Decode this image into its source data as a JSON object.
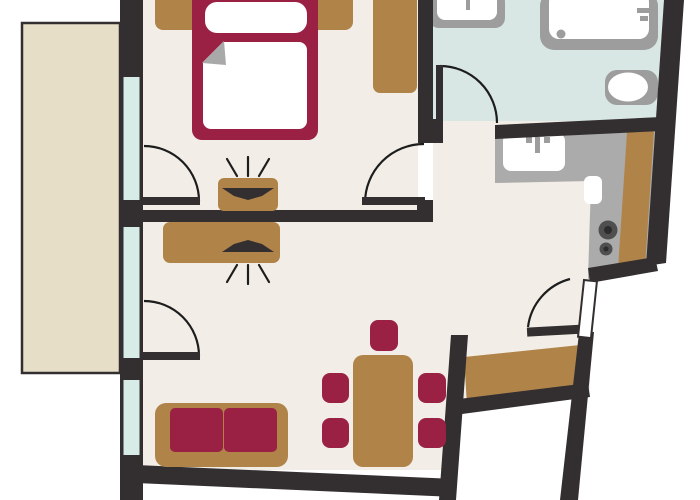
{
  "title": "apartment-floor-plan",
  "canvas": {
    "width": 700,
    "height": 500
  },
  "colors": {
    "white": "#ffffff",
    "wall": "#332e30",
    "line": "#1d1d1d",
    "floor": "#f2eee7",
    "balcony": "#e6dec7",
    "glass": "#d7ebe7",
    "bathroom_floor": "#d9e7e4",
    "counter": "#ababab",
    "fixture": "#9d9d9d",
    "accent_maroon": "#9b2144",
    "wood_brown": "#b08449",
    "burner_outer": "#4f4f4f",
    "burner_inner": "#2c2c2c",
    "fold_gray": "#a9a9a9"
  },
  "rooms": {
    "bedroom": {
      "label": "Bedroom",
      "items": [
        "double-bed",
        "pillow",
        "duvet",
        "headboard",
        "wardrobe",
        "tv-cabinet",
        "balcony-door",
        "window"
      ]
    },
    "living_room": {
      "label": "Living room",
      "items": [
        "sofa",
        "tv-cabinet",
        "dining-table",
        "dining-chairs",
        "balcony-door",
        "window"
      ]
    },
    "bathroom": {
      "label": "Bathroom",
      "items": [
        "shower",
        "washbasin",
        "toilet",
        "door"
      ]
    },
    "kitchen": {
      "label": "Kitchenette",
      "items": [
        "l-shaped-counter",
        "sink",
        "cooktop-burners",
        "cabinet-strip"
      ]
    },
    "balcony": {
      "label": "Balcony",
      "items": []
    },
    "entry": {
      "label": "Entry hall",
      "items": [
        "entrance-door",
        "hall-floor"
      ]
    }
  },
  "counts": {
    "windows": 3,
    "interior_doors": 4,
    "balcony_doors": 2,
    "dining_chairs": 5,
    "cooktop_burners": 2
  }
}
